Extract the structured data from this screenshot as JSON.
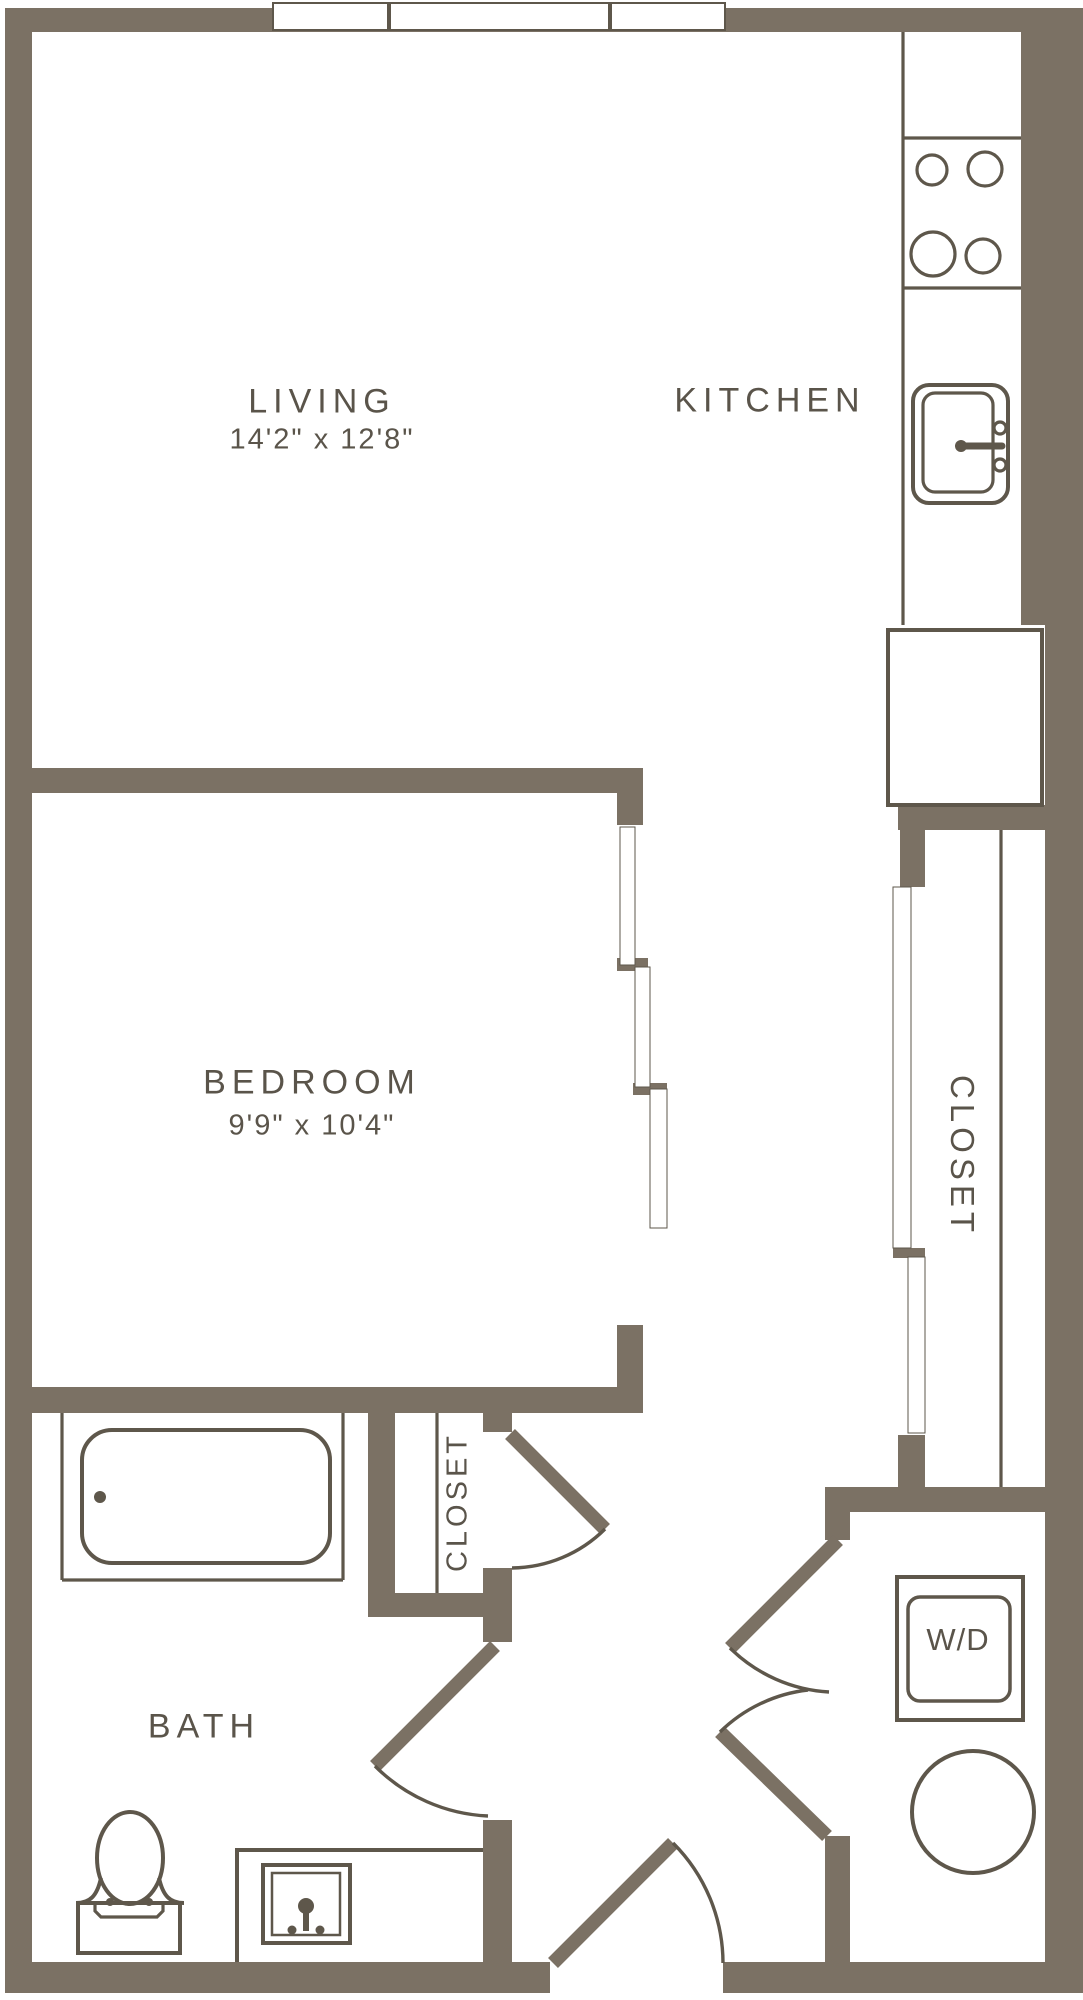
{
  "colors": {
    "wall": "#7b7164",
    "line": "#5e574b",
    "text": "#5a544a",
    "floor": "#ffffff"
  },
  "rooms": {
    "living": {
      "name": "LIVING",
      "dimensions": "14'2\" x 12'8\""
    },
    "kitchen": {
      "name": "KITCHEN"
    },
    "bedroom": {
      "name": "BEDROOM",
      "dimensions": "9'9\" x 10'4\""
    },
    "bath": {
      "name": "BATH"
    },
    "closet_hall": {
      "name": "CLOSET"
    },
    "closet_right": {
      "name": "CLOSET"
    },
    "laundry": {
      "name": "W/D"
    }
  }
}
